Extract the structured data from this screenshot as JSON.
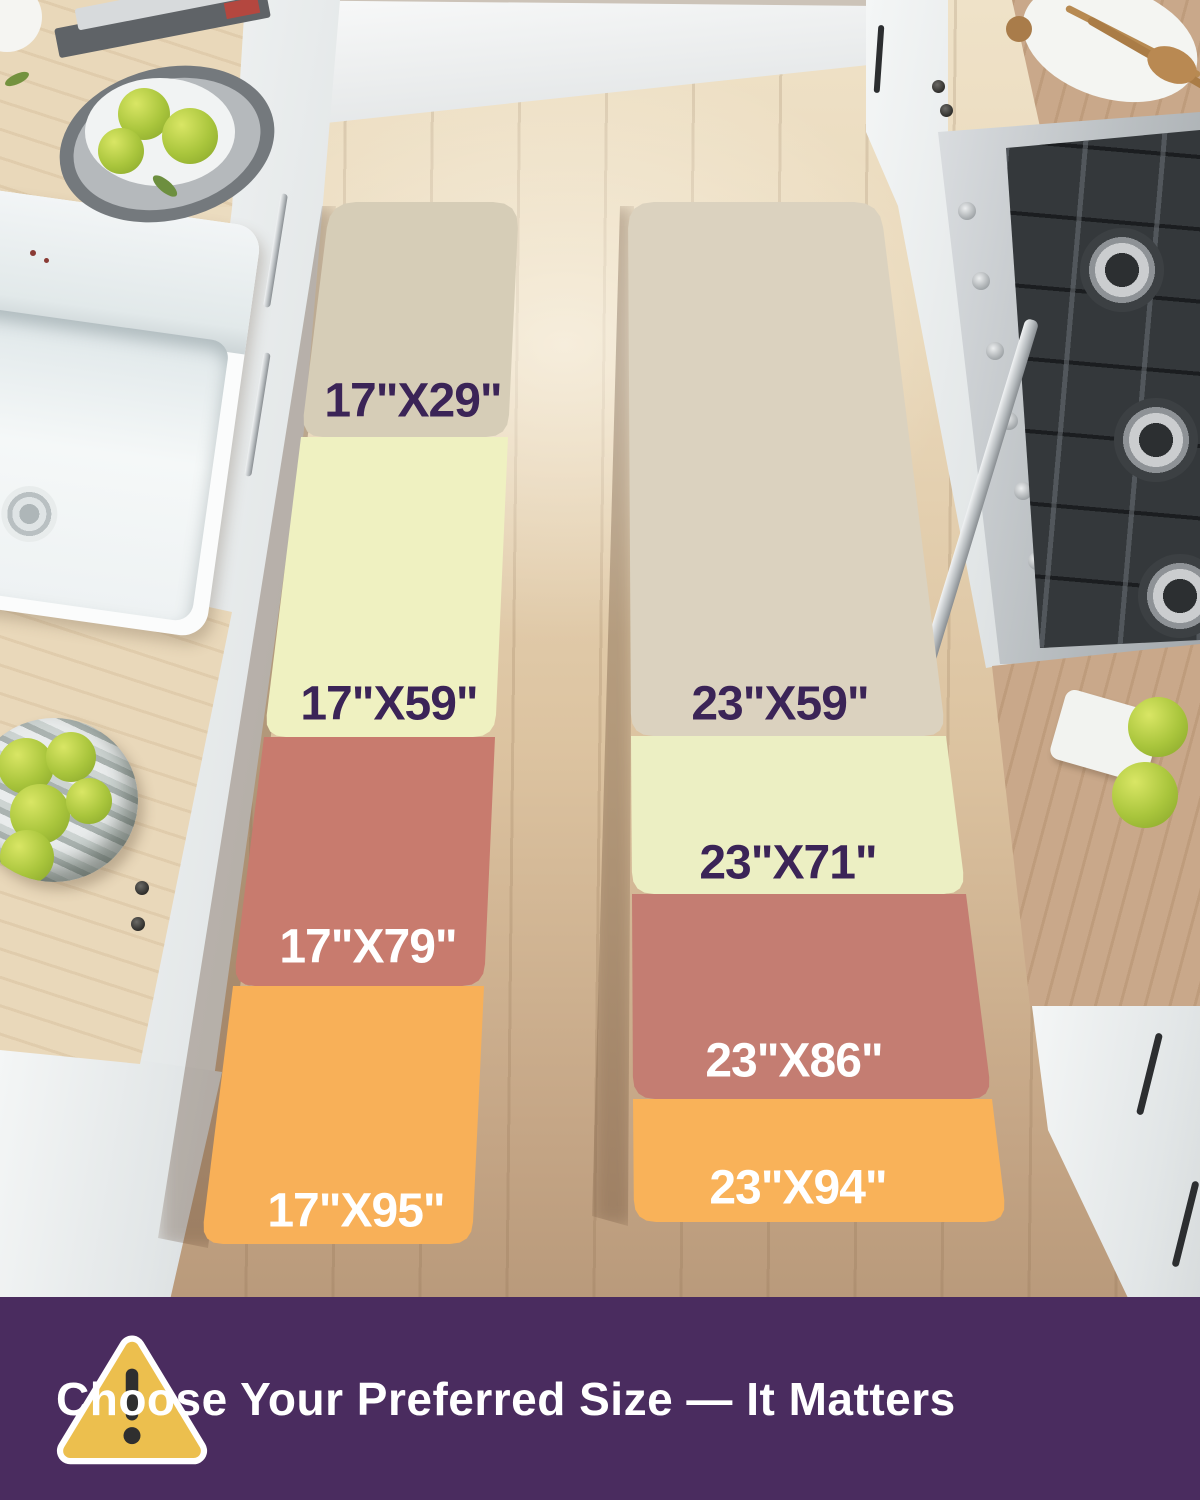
{
  "size_chart": {
    "left_column": {
      "sizes": [
        {
          "label": "17\"X29\"",
          "swatch_color": "#d6cdb7",
          "label_color": "#3b2457"
        },
        {
          "label": "17\"X59\"",
          "swatch_color": "#eff1c1",
          "label_color": "#3b2457"
        },
        {
          "label": "17\"X79\"",
          "swatch_color": "#c87b6e",
          "label_color": "#ffffff"
        },
        {
          "label": "17\"X95\"",
          "swatch_color": "#f8b058",
          "label_color": "#ffffff"
        }
      ]
    },
    "right_column": {
      "sizes": [
        {
          "label": "23\"X59\"",
          "swatch_color": "#dbd2bf",
          "label_color": "#3b2457"
        },
        {
          "label": "23\"X71\"",
          "swatch_color": "#ecefc3",
          "label_color": "#3b2457"
        },
        {
          "label": "23\"X86\"",
          "swatch_color": "#c47d72",
          "label_color": "#ffffff"
        },
        {
          "label": "23\"X94\"",
          "swatch_color": "#f9b259",
          "label_color": "#ffffff"
        }
      ]
    }
  },
  "banner": {
    "text": "Choose Your Preferred Size — It Matters",
    "background_color": "#4a2c5f",
    "text_color": "#ffffff",
    "icon": "warning-triangle-icon",
    "icon_fill": "#ecbf4e",
    "icon_border": "#ffffff",
    "icon_mark_color": "#2f2f2f"
  }
}
